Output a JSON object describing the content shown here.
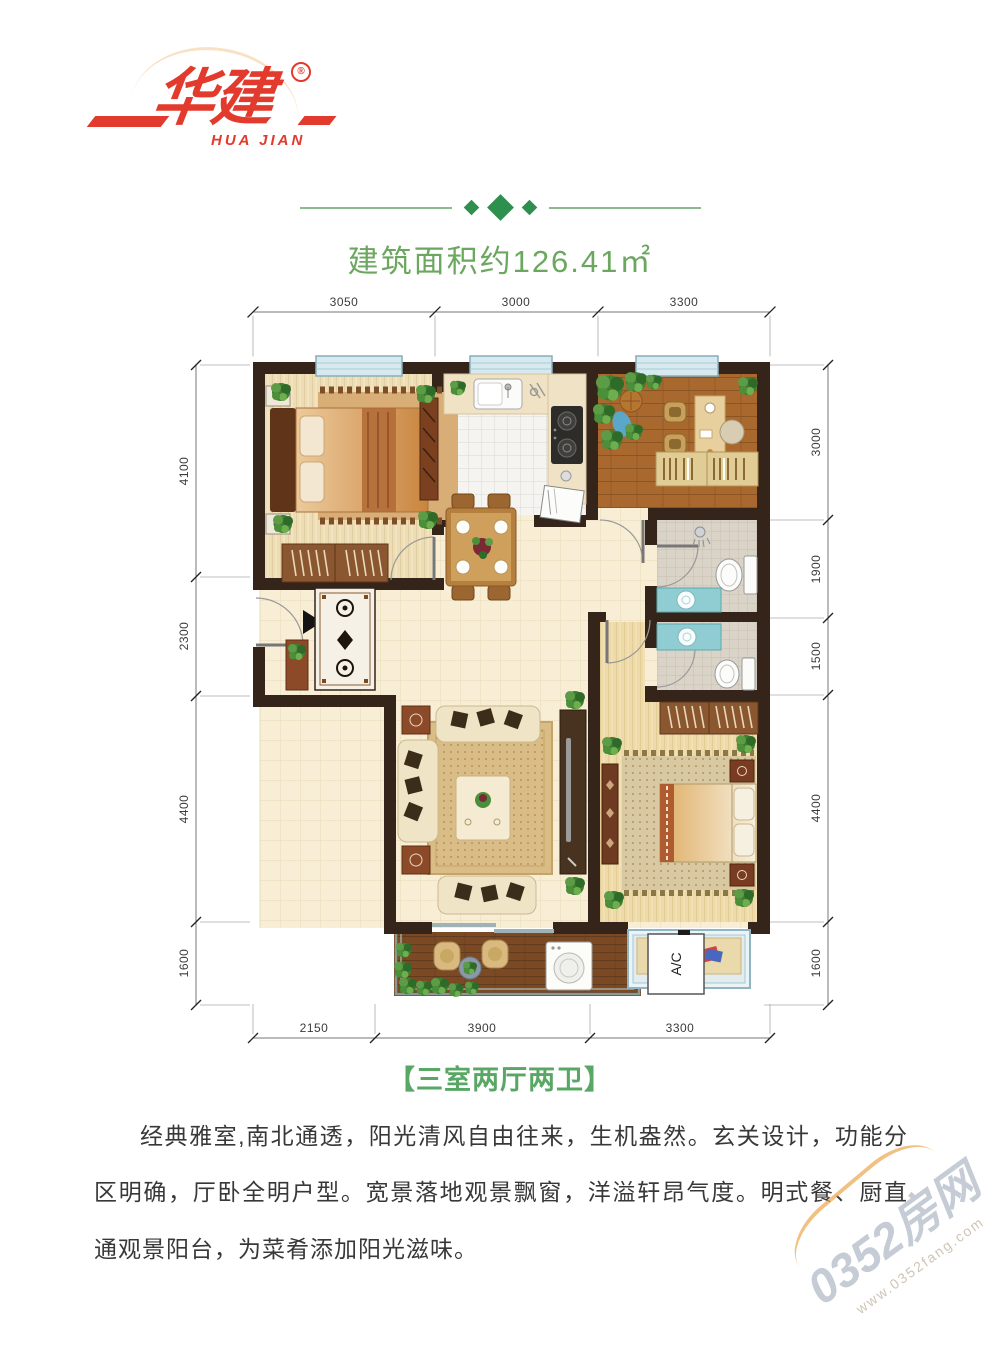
{
  "logo": {
    "brand": "华建",
    "latin": "HUA JIAN",
    "reg": "®"
  },
  "header": {
    "area_title": "建筑面积约126.41㎡"
  },
  "plan": {
    "dims": {
      "top": [
        "3050",
        "3000",
        "3300"
      ],
      "bottom": [
        "2150",
        "3900",
        "3300"
      ],
      "left": [
        "4100",
        "2300",
        "4400",
        "1600"
      ],
      "right": [
        "3000",
        "1900",
        "1500",
        "4400",
        "1600"
      ]
    },
    "ac_label": "A/C"
  },
  "footer": {
    "type_label": "【三室两厅两卫】",
    "description": "经典雅室,南北通透，阳光清风自由往来，生机盎然。玄关设计，功能分区明确，厅卧全明户型。宽景落地观景飘窗，洋溢轩昂气度。明式餐、厨直通观景阳台，为菜肴添加阳光滋味。"
  },
  "watermark": {
    "site": "0352房网",
    "url": "www.0352fang.com"
  },
  "colors": {
    "brand_red": "#e23a2c",
    "accent_green": "#6ca75f",
    "label_green": "#58a765",
    "wall_brown": "#342419"
  }
}
